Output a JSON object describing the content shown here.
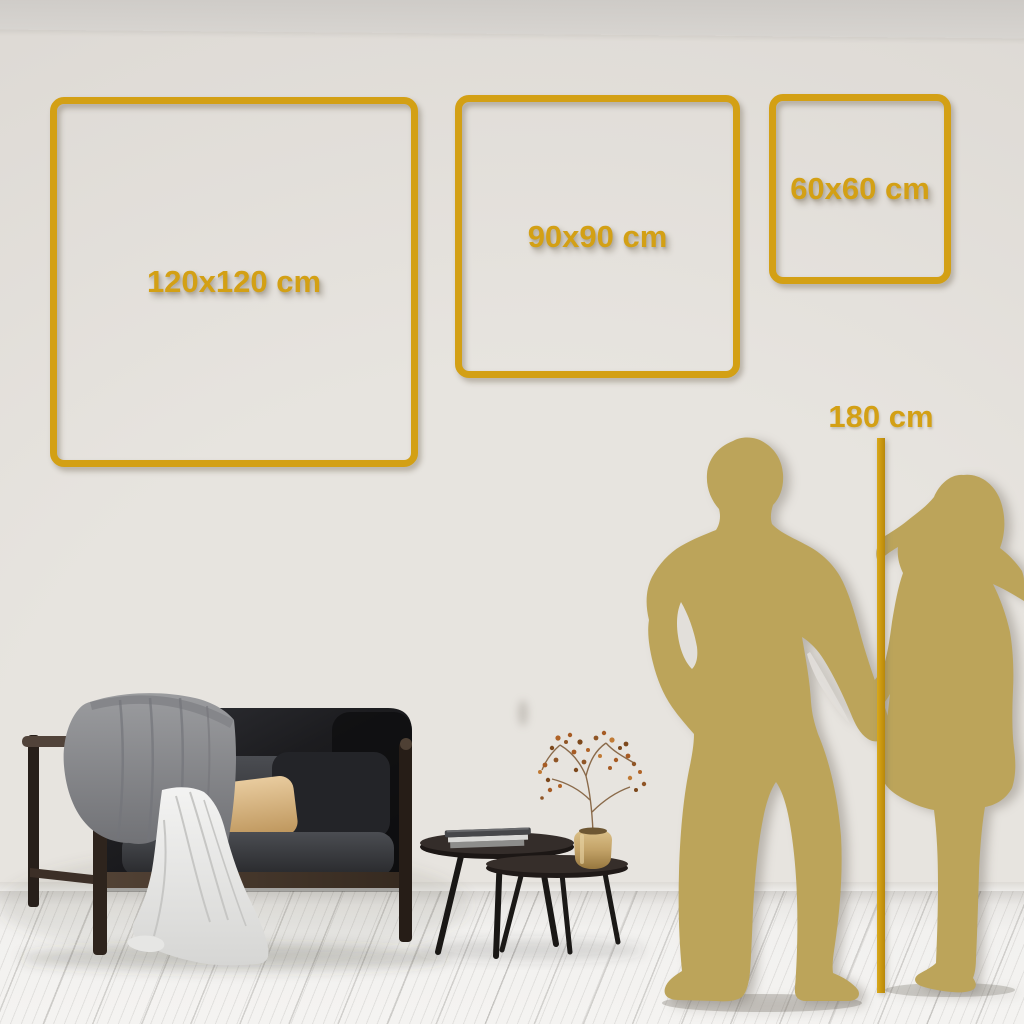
{
  "size_guide": {
    "frames": [
      {
        "size": "120x120",
        "label": "120x120 cm"
      },
      {
        "size": "90x90",
        "label": "90x90 cm"
      },
      {
        "size": "60x60",
        "label": "60x60 cm"
      }
    ],
    "height_marker": {
      "label": "180 cm"
    }
  },
  "scene": {
    "illustrations": [
      {
        "name": "couple-silhouette",
        "meaning": "man and woman holding hands as 180 cm height reference"
      },
      {
        "name": "sofa",
        "meaning": "dark high-back sofa with cushions, gray blanket and white throw"
      },
      {
        "name": "nesting-coffee-tables",
        "meaning": "two round dark tables with books and brass vase with dried berry branch"
      }
    ]
  },
  "colors": {
    "accent_gold": "#D3A015",
    "ruler_gold": "#C9960F",
    "silhouette_gold": "#BCA45A",
    "wall": "#E4E1DC",
    "floor": "#F1F0EE"
  }
}
